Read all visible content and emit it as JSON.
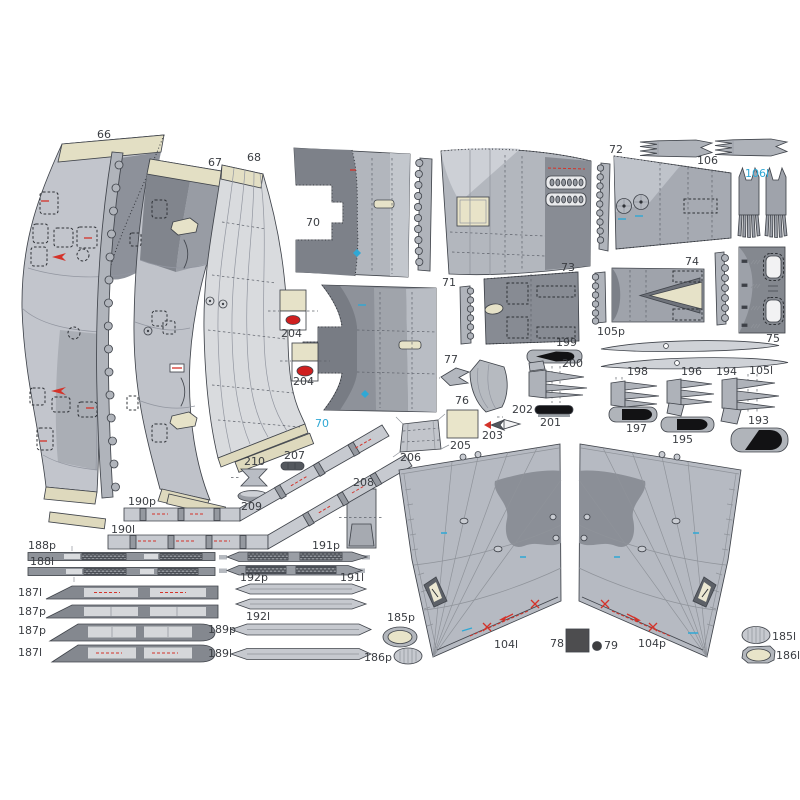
{
  "sheet": {
    "type": "paper-model-parts-sheet",
    "background": "#ffffff"
  },
  "palette": {
    "outline": "#41454c",
    "gray_light": "#c6c9cf",
    "gray_mid": "#a9adb5",
    "gray_dark": "#868a92",
    "gray_deep": "#757981",
    "panel_light": "#d9dbde",
    "cream": "#e6e2c8",
    "cream_tab": "#ded9bd",
    "red": "#d4332a",
    "cyan": "#2fa8d5",
    "black_detail": "#141417",
    "dark_square": "#4d4d4f",
    "label_color": "#3a3d42"
  },
  "parts_inventory": [
    "66",
    "67",
    "68",
    "70",
    "71",
    "72",
    "73",
    "74",
    "75",
    "76",
    "77",
    "78",
    "79",
    "104l",
    "104p",
    "105l",
    "105p",
    "106",
    "106l",
    "185l",
    "185p",
    "186l",
    "186p",
    "187l",
    "187p",
    "188l",
    "188p",
    "189l",
    "189p",
    "190l",
    "190p",
    "191l",
    "191p",
    "192l",
    "192p",
    "193",
    "194",
    "195",
    "196",
    "197",
    "198",
    "199",
    "200",
    "201",
    "202",
    "203",
    "204",
    "205",
    "206",
    "207",
    "208",
    "209",
    "210"
  ],
  "labels": [
    {
      "id": "66",
      "text": "66",
      "x": 97,
      "y": 138
    },
    {
      "id": "67",
      "text": "67",
      "x": 208,
      "y": 166
    },
    {
      "id": "68",
      "text": "68",
      "x": 247,
      "y": 161
    },
    {
      "id": "70",
      "text": "70",
      "x": 306,
      "y": 226
    },
    {
      "id": "70b",
      "text": "70",
      "x": 315,
      "y": 427,
      "color": "#2fa8d5"
    },
    {
      "id": "71",
      "text": "71",
      "x": 442,
      "y": 286
    },
    {
      "id": "72",
      "text": "72",
      "x": 609,
      "y": 153
    },
    {
      "id": "73",
      "text": "73",
      "x": 561,
      "y": 271
    },
    {
      "id": "74",
      "text": "74",
      "x": 685,
      "y": 265
    },
    {
      "id": "75",
      "text": "75",
      "x": 766,
      "y": 342
    },
    {
      "id": "76",
      "text": "76",
      "x": 455,
      "y": 404
    },
    {
      "id": "77",
      "text": "77",
      "x": 444,
      "y": 363
    },
    {
      "id": "78",
      "text": "78",
      "x": 550,
      "y": 647
    },
    {
      "id": "79",
      "text": "79",
      "x": 604,
      "y": 649
    },
    {
      "id": "104l",
      "text": "104l",
      "x": 494,
      "y": 648
    },
    {
      "id": "104p",
      "text": "104p",
      "x": 638,
      "y": 647
    },
    {
      "id": "105p",
      "text": "105p",
      "x": 597,
      "y": 335
    },
    {
      "id": "105l",
      "text": "105l",
      "x": 749,
      "y": 374
    },
    {
      "id": "106",
      "text": "106",
      "x": 697,
      "y": 164
    },
    {
      "id": "106l",
      "text": "106l",
      "x": 745,
      "y": 177,
      "color": "#2fa8d5"
    },
    {
      "id": "185p",
      "text": "185p",
      "x": 387,
      "y": 621
    },
    {
      "id": "185l",
      "text": "185l",
      "x": 772,
      "y": 640
    },
    {
      "id": "186p",
      "text": "186p",
      "x": 364,
      "y": 661
    },
    {
      "id": "186l",
      "text": "186l",
      "x": 776,
      "y": 659
    },
    {
      "id": "187l",
      "text": "187l",
      "x": 18,
      "y": 596
    },
    {
      "id": "187p",
      "text": "187p",
      "x": 18,
      "y": 615
    },
    {
      "id": "187p-2",
      "text": "187p",
      "x": 18,
      "y": 634
    },
    {
      "id": "187l-2",
      "text": "187l",
      "x": 18,
      "y": 656
    },
    {
      "id": "188p",
      "text": "188p",
      "x": 28,
      "y": 549
    },
    {
      "id": "188l",
      "text": "188l",
      "x": 30,
      "y": 565
    },
    {
      "id": "189p",
      "text": "189p",
      "x": 208,
      "y": 633
    },
    {
      "id": "189l",
      "text": "189l",
      "x": 208,
      "y": 657
    },
    {
      "id": "190p",
      "text": "190p",
      "x": 128,
      "y": 505
    },
    {
      "id": "190l",
      "text": "190l",
      "x": 111,
      "y": 533
    },
    {
      "id": "191p",
      "text": "191p",
      "x": 312,
      "y": 549
    },
    {
      "id": "191l",
      "text": "191l",
      "x": 340,
      "y": 581
    },
    {
      "id": "192p",
      "text": "192p",
      "x": 240,
      "y": 581
    },
    {
      "id": "192l",
      "text": "192l",
      "x": 246,
      "y": 620
    },
    {
      "id": "193",
      "text": "193",
      "x": 748,
      "y": 424
    },
    {
      "id": "194",
      "text": "194",
      "x": 716,
      "y": 375
    },
    {
      "id": "195",
      "text": "195",
      "x": 672,
      "y": 443
    },
    {
      "id": "196",
      "text": "196",
      "x": 681,
      "y": 375
    },
    {
      "id": "197",
      "text": "197",
      "x": 626,
      "y": 432
    },
    {
      "id": "198",
      "text": "198",
      "x": 627,
      "y": 375
    },
    {
      "id": "199",
      "text": "199",
      "x": 556,
      "y": 346
    },
    {
      "id": "200",
      "text": "200",
      "x": 562,
      "y": 367
    },
    {
      "id": "201",
      "text": "201",
      "x": 540,
      "y": 426
    },
    {
      "id": "202",
      "text": "202",
      "x": 512,
      "y": 413
    },
    {
      "id": "203",
      "text": "203",
      "x": 482,
      "y": 439
    },
    {
      "id": "204a",
      "text": "204",
      "x": 281,
      "y": 337
    },
    {
      "id": "204b",
      "text": "204",
      "x": 293,
      "y": 385
    },
    {
      "id": "205",
      "text": "205",
      "x": 450,
      "y": 449
    },
    {
      "id": "206",
      "text": "206",
      "x": 400,
      "y": 461
    },
    {
      "id": "207",
      "text": "207",
      "x": 284,
      "y": 459
    },
    {
      "id": "208",
      "text": "208",
      "x": 353,
      "y": 486
    },
    {
      "id": "209",
      "text": "209",
      "x": 241,
      "y": 510
    },
    {
      "id": "210",
      "text": "210",
      "x": 244,
      "y": 465
    }
  ]
}
